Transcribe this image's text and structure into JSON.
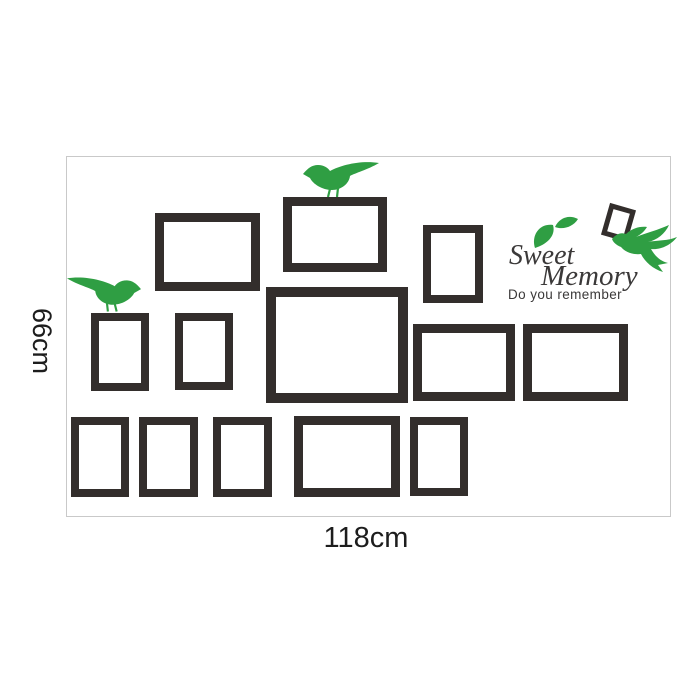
{
  "labels": {
    "width": "118cm",
    "height": "66cm"
  },
  "brand": {
    "line1": "Sweet",
    "line2": "Memory",
    "subtitle": "Do you remember"
  },
  "colors": {
    "accent_green": "#2f9e43",
    "frame_black": "#332e2c",
    "text_gray": "#3b3939",
    "dimension_text": "#1d1d1d",
    "wall_outline": "#c9c9c9"
  },
  "icons": [
    "standing-bird-icon",
    "standing-bird-mirrored-icon",
    "flying-bird-icon",
    "leaf-sprig-icon"
  ],
  "frames": {
    "count": 14,
    "items": [
      {
        "name": "frame-top-left-medium",
        "x": 155,
        "y": 213,
        "w": 105,
        "h": 78,
        "b": 9
      },
      {
        "name": "frame-top-center-medium",
        "x": 283,
        "y": 197,
        "w": 104,
        "h": 75,
        "b": 9
      },
      {
        "name": "frame-top-right-small",
        "x": 423,
        "y": 225,
        "w": 60,
        "h": 78,
        "b": 8
      },
      {
        "name": "frame-mid-left-small-1",
        "x": 91,
        "y": 313,
        "w": 58,
        "h": 78,
        "b": 8
      },
      {
        "name": "frame-mid-left-small-2",
        "x": 175,
        "y": 313,
        "w": 58,
        "h": 77,
        "b": 8
      },
      {
        "name": "frame-center-large",
        "x": 266,
        "y": 287,
        "w": 142,
        "h": 116,
        "b": 10
      },
      {
        "name": "frame-mid-right-medium-1",
        "x": 413,
        "y": 324,
        "w": 102,
        "h": 77,
        "b": 9
      },
      {
        "name": "frame-mid-right-medium-2",
        "x": 523,
        "y": 324,
        "w": 105,
        "h": 77,
        "b": 9
      },
      {
        "name": "frame-bottom-small-1",
        "x": 71,
        "y": 417,
        "w": 58,
        "h": 80,
        "b": 8
      },
      {
        "name": "frame-bottom-small-2",
        "x": 139,
        "y": 417,
        "w": 59,
        "h": 80,
        "b": 8
      },
      {
        "name": "frame-bottom-small-3",
        "x": 213,
        "y": 417,
        "w": 59,
        "h": 80,
        "b": 8
      },
      {
        "name": "frame-bottom-medium",
        "x": 294,
        "y": 416,
        "w": 106,
        "h": 81,
        "b": 9
      },
      {
        "name": "frame-bottom-small-4",
        "x": 410,
        "y": 417,
        "w": 58,
        "h": 79,
        "b": 8
      },
      {
        "name": "frame-tilted-mini",
        "x": 605,
        "y": 206,
        "w": 27,
        "h": 33,
        "b": 5,
        "rotate": 16
      }
    ]
  }
}
